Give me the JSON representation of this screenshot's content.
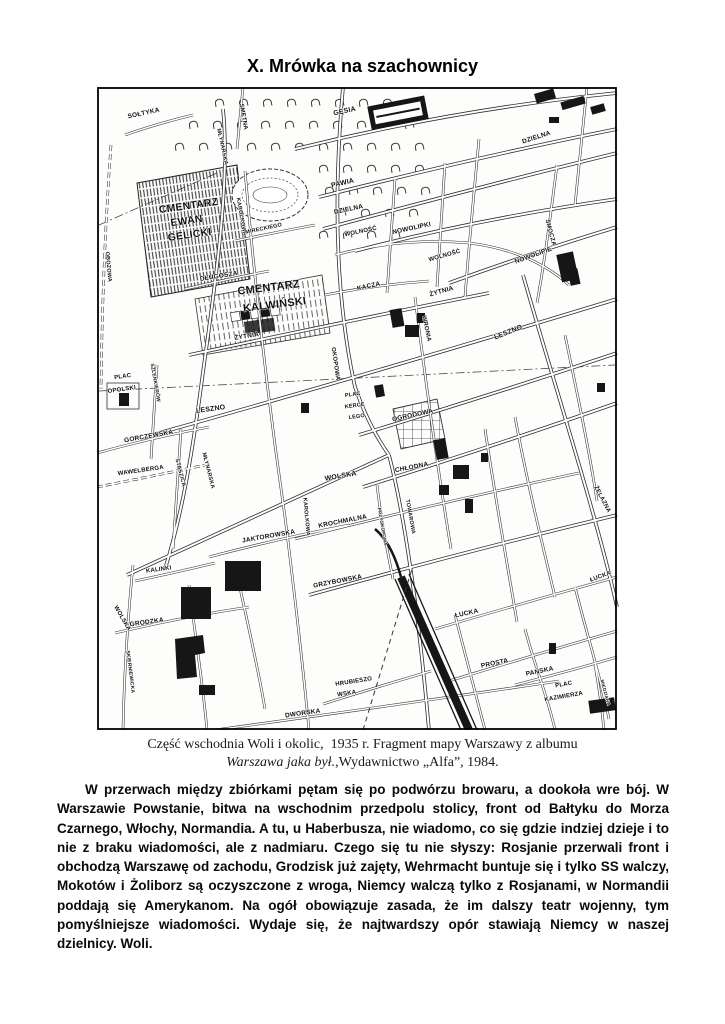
{
  "page": {
    "title": "X. Mrówka na szachownicy"
  },
  "map": {
    "caption": {
      "line1": "Część wschodnia Woli i okolic,  1935 r. Fragment mapy Warszawy z albumu",
      "line2_italic": "Warszawa jaka był.",
      "line2_rest": ",Wydawnictwo „Alfa”, 1984."
    },
    "labels": [
      [
        "SOŁTYKA",
        47,
        28,
        -12,
        6.5
      ],
      [
        "SMĘTNA",
        145,
        30,
        80,
        6
      ],
      [
        "OBOZOWA",
        10,
        180,
        85,
        5.5
      ],
      [
        "MŁYNARSKA",
        124,
        60,
        78,
        5.5
      ],
      [
        "GĘSIA",
        248,
        26,
        -12,
        7
      ],
      [
        "PAWIA",
        246,
        98,
        -13,
        7
      ],
      [
        "DZIELNA",
        252,
        124,
        -12,
        6.5
      ],
      [
        "DZIELNA",
        440,
        52,
        -18,
        6.5
      ],
      [
        "WOLNOŚĆ",
        264,
        146,
        -12,
        6
      ],
      [
        "NOWOLIPKI",
        315,
        143,
        -12,
        6.5
      ],
      [
        "NOWOLIPIE",
        437,
        170,
        -20,
        6.5
      ],
      [
        "SMOCZA",
        452,
        146,
        75,
        6
      ],
      [
        "KACZA",
        272,
        201,
        -12,
        6.5
      ],
      [
        "ŻYTNIA",
        150,
        251,
        -9,
        6.5
      ],
      [
        "ŻYTNIA",
        345,
        206,
        -16,
        6.5
      ],
      [
        "WOLNOŚĆ",
        348,
        170,
        -16,
        6
      ],
      [
        "KAROLKOWA",
        143,
        130,
        80,
        5.5
      ],
      [
        "KAROLKOWA",
        208,
        430,
        85,
        5.5
      ],
      [
        "OKOPOWA",
        237,
        277,
        82,
        6
      ],
      [
        "DŁUGOSZA",
        122,
        191,
        -9,
        6.5
      ],
      [
        "CMENTARZ",
        92,
        122,
        -8,
        10.5
      ],
      [
        "EWAN",
        90,
        137,
        -8,
        10.5
      ],
      [
        "GELICKI",
        93,
        151,
        -8,
        10.5
      ],
      [
        "CMENTARZ",
        172,
        204,
        -7,
        11
      ],
      [
        "KALWIŃSKI",
        178,
        221,
        -7,
        11
      ],
      [
        "MIRECKIEGO",
        167,
        143,
        -12,
        5.5
      ],
      [
        "LESZNO",
        114,
        324,
        -8,
        7
      ],
      [
        "LESZNO",
        412,
        247,
        -22,
        7
      ],
      [
        "PLAC",
        26,
        291,
        -8,
        6
      ],
      [
        "OPOLSKI",
        25,
        304,
        -8,
        6
      ],
      [
        "SZLENKIERÓW",
        57,
        296,
        80,
        5
      ],
      [
        "GORCZEWSKA",
        52,
        351,
        -10,
        6.5
      ],
      [
        "STASZICA",
        82,
        386,
        76,
        5.5
      ],
      [
        "WAWELBERGA",
        44,
        385,
        -8,
        6
      ],
      [
        "MŁYNARSKA",
        110,
        384,
        76,
        5.5
      ],
      [
        "PLAC",
        256,
        309,
        -8,
        5.5
      ],
      [
        "KERCE",
        258,
        320,
        -8,
        5.5
      ],
      [
        "LEGO",
        260,
        331,
        -8,
        5.5
      ],
      [
        "WOLSKA",
        244,
        391,
        -10,
        7
      ],
      [
        "OGRODOWA",
        316,
        330,
        -12,
        6.5
      ],
      [
        "CHŁODNA",
        315,
        382,
        -11,
        6.5
      ],
      [
        "WRONIA",
        328,
        242,
        78,
        6
      ],
      [
        "TOWAROWA",
        312,
        430,
        80,
        5.5
      ],
      [
        "PRZYOKOPOWA",
        284,
        440,
        80,
        4.5
      ],
      [
        "KROCHMALNA",
        246,
        436,
        -11,
        6.5
      ],
      [
        "GRZYBOWSKA",
        241,
        496,
        -11,
        6.5
      ],
      [
        "ŻELAZNA",
        504,
        413,
        62,
        6
      ],
      [
        "JAKTOROWSKA",
        172,
        451,
        -10,
        6.5
      ],
      [
        "KALINKI",
        62,
        484,
        -8,
        6
      ],
      [
        "GRODZKA",
        50,
        537,
        -8,
        6.5
      ],
      [
        "SKIERNIEWICKA",
        32,
        585,
        83,
        5
      ],
      [
        "WOLSKA",
        24,
        532,
        60,
        6
      ],
      [
        "ŁUCKA",
        370,
        528,
        -12,
        6.5
      ],
      [
        "ŁUCKA",
        504,
        491,
        -20,
        6
      ],
      [
        "PROSTA",
        398,
        578,
        -12,
        6.5
      ],
      [
        "PAŃSKA",
        443,
        586,
        -12,
        6.5
      ],
      [
        "PLAC",
        467,
        599,
        -10,
        6
      ],
      [
        "KAZIMIERZA",
        467,
        611,
        -10,
        6
      ],
      [
        "DWORSKA",
        206,
        628,
        -8,
        6.5
      ],
      [
        "HRUBIESZO",
        257,
        596,
        -9,
        6
      ],
      [
        "WSKA",
        250,
        608,
        -9,
        6
      ],
      [
        "MIEDZIANA",
        507,
        606,
        75,
        4.5
      ]
    ],
    "glyph_rows": [
      [
        14,
        118,
        330
      ],
      [
        36,
        92,
        330
      ],
      [
        58,
        78,
        330
      ],
      [
        80,
        78,
        330
      ],
      [
        102,
        84,
        330
      ],
      [
        124,
        96,
        325
      ],
      [
        146,
        150,
        300
      ]
    ]
  },
  "body": {
    "paragraph": "W przerwach między zbiórkami pętam się po podwórzu browaru, a dookoła wre bój. W Warszawie Powstanie, bitwa na wschodnim przedpolu stolicy, front od Bałtyku do Morza Czarnego, Włochy, Normandia. A tu, u Haberbusza, nie wiadomo, co się gdzie indziej dzieje i to nie z braku wiadomości, ale z nadmiaru. Czego się tu nie słyszy: Rosjanie przerwali front i obchodzą Warszawę od zachodu, Grodzisk już zajęty, Wehrmacht buntuje się i tylko SS walczy, Mokotów i Żoliborz są oczyszczone z wroga, Niemcy walczą tylko z Rosjanami, w Normandii poddają się Amerykanom. Na ogół obowiązuje zasada, że im dalszy teatr wojenny, tym pomyślniejsze wiadomości. Wydaje się, że najtwardszy opór stawiają Niemcy w naszej dzielnicy. Woli."
  }
}
